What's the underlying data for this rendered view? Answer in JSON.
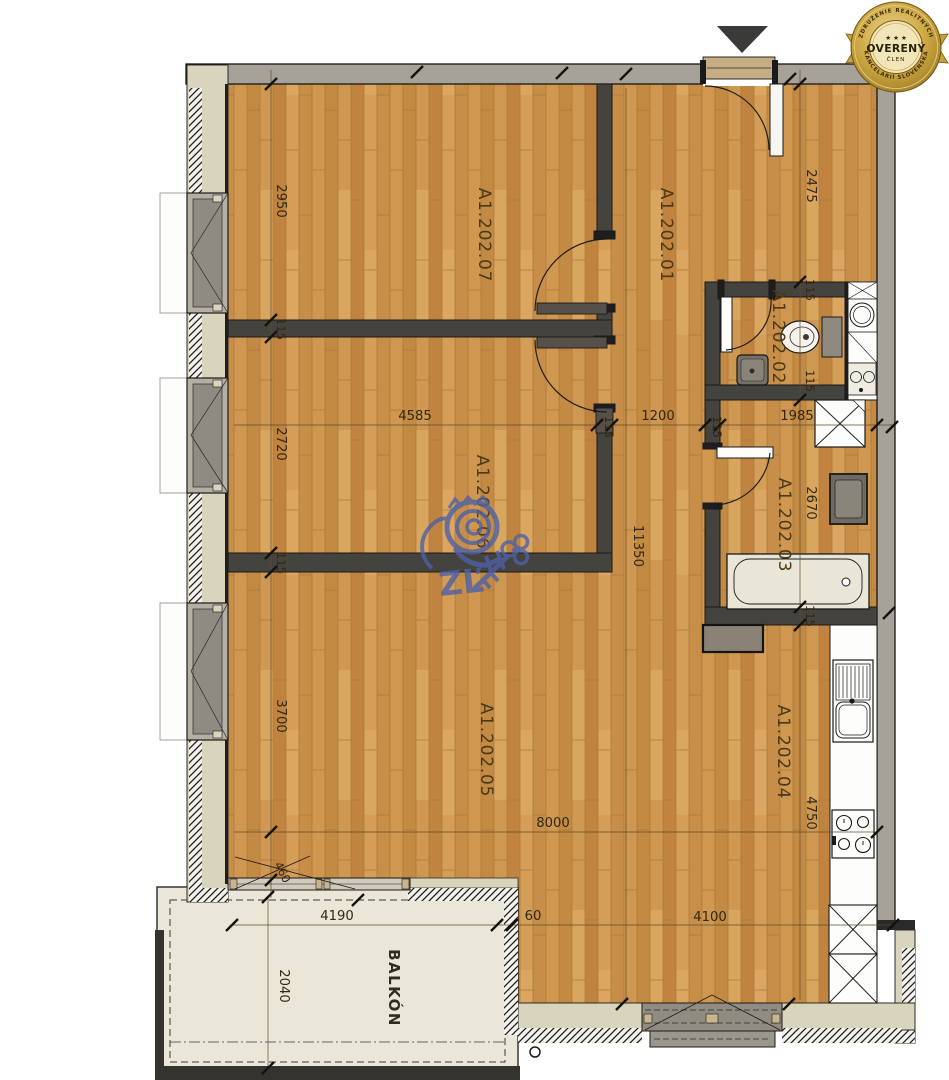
{
  "badge": {
    "ring_top": "ZDRUŽENIE REALITNÝCH",
    "ring_bottom": "KANCELÁRIÍ SLOVENSKA",
    "stars": "★ ★ ★",
    "label": "OVERENÝ",
    "sublabel": "ČLEN"
  },
  "rooms": {
    "r01": "A1.202.01",
    "r02": "A1.202.02",
    "r03": "A1.202.03",
    "r04": "A1.202.04",
    "r05": "A1.202.05",
    "r06": "A1.202.06",
    "r07": "A1.202.07",
    "balcony": "BALKÓN"
  },
  "dims": {
    "d2950": "2950",
    "d2475": "2475",
    "d2720": "2720",
    "d3700": "3700",
    "d4585": "4585",
    "d1200": "1200",
    "d1985": "1985",
    "d2670": "2670",
    "d11350": "11350",
    "d4750": "4750",
    "d8000": "8000",
    "d4190": "4190",
    "d4100": "4100",
    "d2040": "2040",
    "d460": "460",
    "d60": "60",
    "d115": "115"
  },
  "watermark": {
    "letters": "ZĽ"
  },
  "colors": {
    "wood": "#cd9850",
    "wall_interior": "#45433d",
    "wall_exterior_gray": "#a6a29a",
    "wall_exterior_cream": "#d9d5bd",
    "balcony_slab": "#eae7d8",
    "badge_gold": "#c9a13b",
    "watermark_blue": "#4d62a8",
    "dimension_text": "#322712"
  }
}
